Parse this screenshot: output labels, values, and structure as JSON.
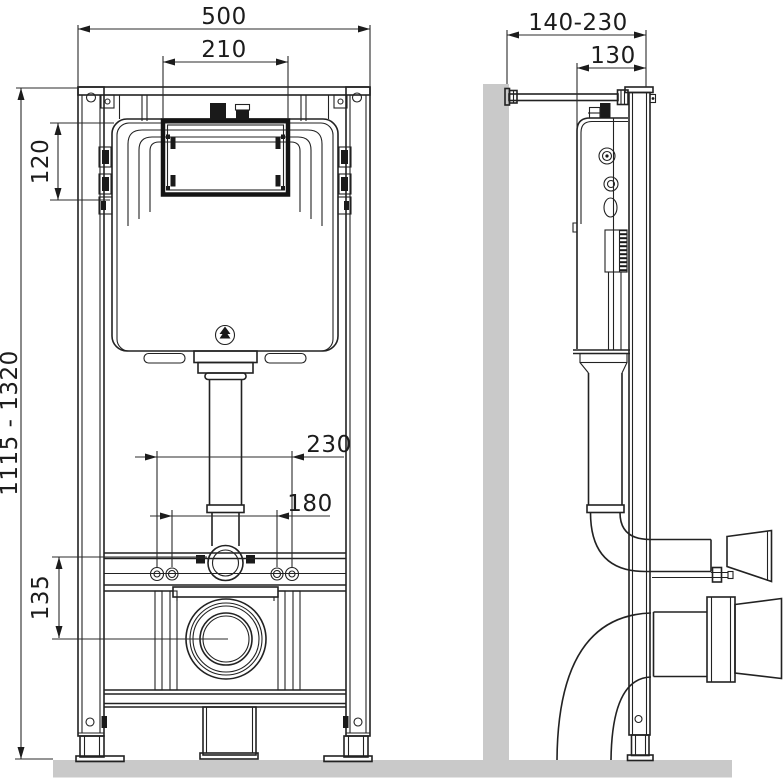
{
  "colors": {
    "line": "#222222",
    "wall_fill": "#c9c9c9",
    "floor_fill": "#c9c9c9"
  },
  "front_view": {
    "width": "500",
    "opening_width": "210",
    "opening_height": "120",
    "install_height_range": "1115 - 1320",
    "outlet_center_height": "135",
    "fixing_spacing_outer": "230",
    "fixing_spacing_inner": "180"
  },
  "side_view": {
    "wall_distance_range": "140-230",
    "frame_depth": "130"
  }
}
